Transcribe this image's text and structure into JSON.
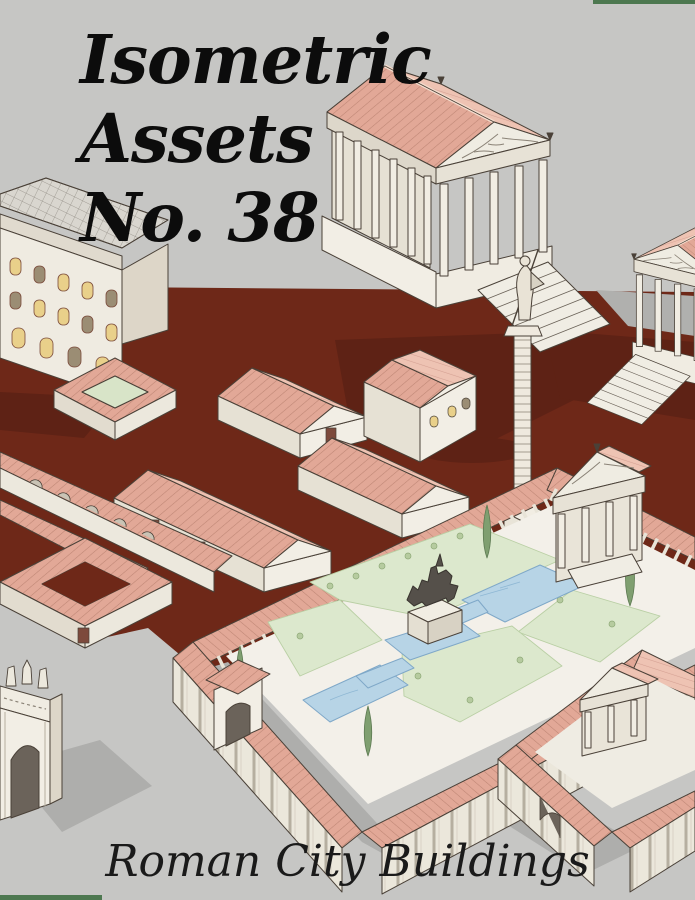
{
  "cover": {
    "title_lines": [
      "Isometric",
      "Assets",
      "No. 38"
    ],
    "subtitle": "Roman City Buildings"
  },
  "colors": {
    "background": "#c6c6c4",
    "ground": "#6e2818",
    "ground_shadow": "#5e2215",
    "soft_shadow": "#aeaeac",
    "roof_tile": "#e2a897",
    "roof_tile_light": "#eec3b3",
    "wall": "#f2eee5",
    "lawn": "#dce8cd",
    "pool": "#b7d4e6",
    "cypress": "#7f9f70",
    "accent_green": "#4d7850",
    "title_text": "#0c0c0c"
  },
  "scene": {
    "elements": [
      "palazzo-insula",
      "grand-temple",
      "side-temple",
      "victory-column",
      "row-houses",
      "courtyard-houses",
      "forum-garden-courtyard",
      "equestrian-statue",
      "reflecting-pools",
      "north-gate-shrine",
      "west-gate",
      "walled-sanctuary",
      "triumphal-arch",
      "cypress-trees"
    ]
  }
}
